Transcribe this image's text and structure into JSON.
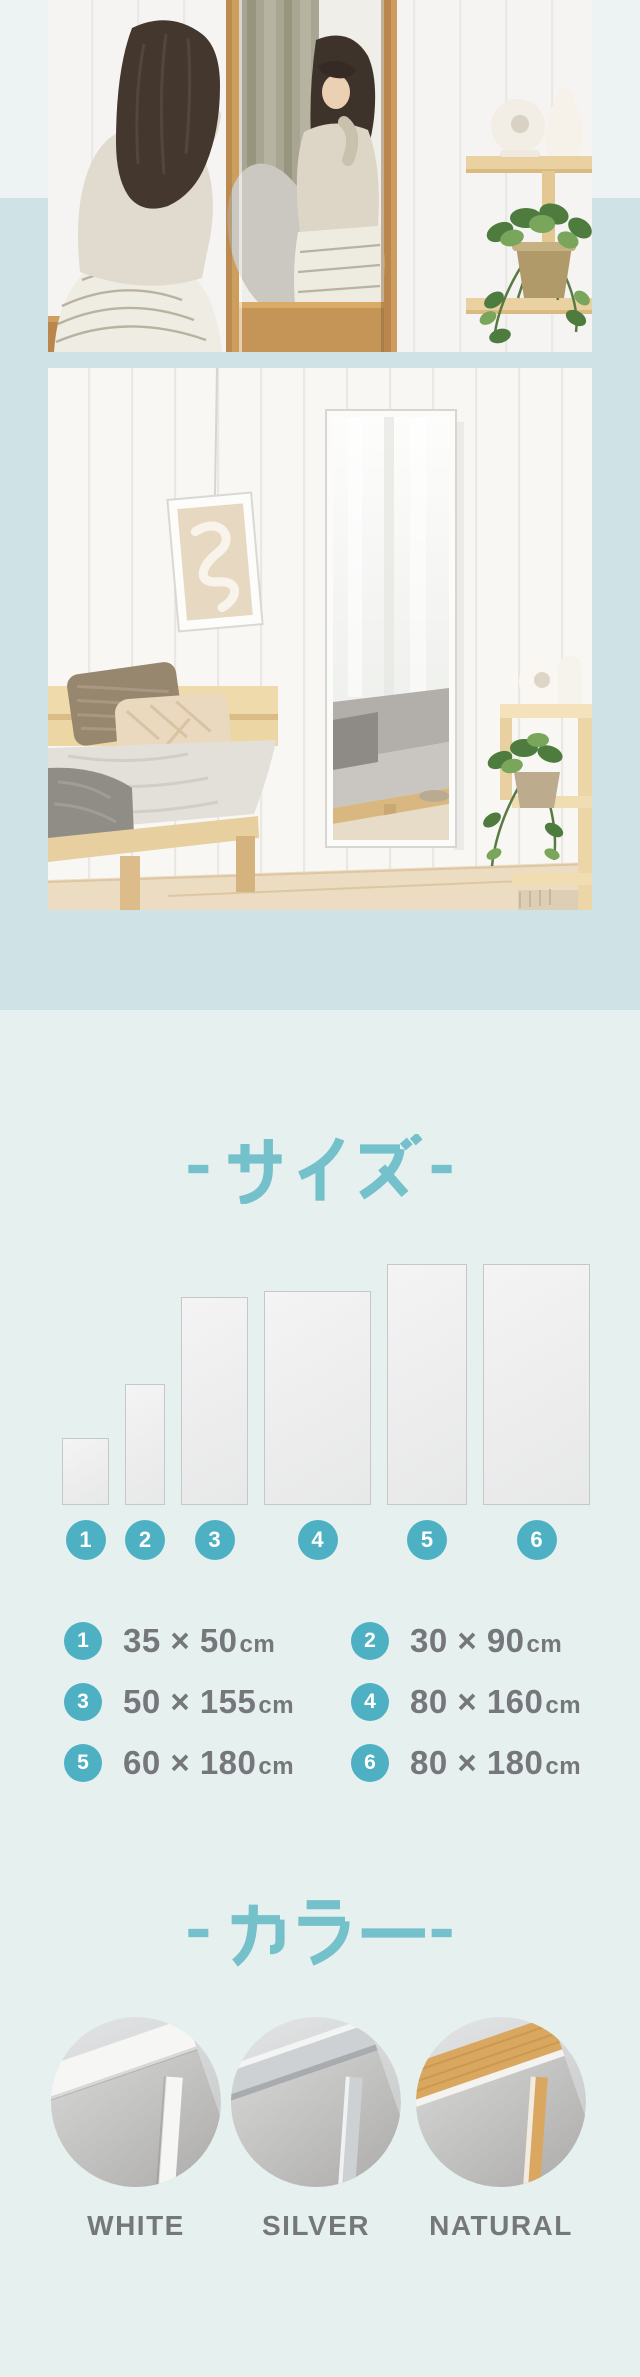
{
  "colors": {
    "accent_teal": "#4db1c3",
    "heading_teal": "#74c0cb",
    "text_grey": "#75777a",
    "band_top": "#edf3f2",
    "band_mid": "#cfe3e7",
    "band_low": "#e5f0ef"
  },
  "photos": {
    "photo1_name": "woman-sitting-in-front-of-wood-frame-full-length-mirror",
    "photo2_name": "white-frame-mirror-on-bedroom-wall"
  },
  "size_section": {
    "heading": "- サイズ -",
    "scale_px_per_cm": 1.34,
    "items": [
      {
        "num": "1",
        "w_cm": 35,
        "h_cm": 50,
        "dims": "35 × 50",
        "unit": "cm"
      },
      {
        "num": "2",
        "w_cm": 30,
        "h_cm": 90,
        "dims": "30 × 90",
        "unit": "cm"
      },
      {
        "num": "3",
        "w_cm": 50,
        "h_cm": 155,
        "dims": "50 × 155",
        "unit": "cm"
      },
      {
        "num": "4",
        "w_cm": 80,
        "h_cm": 160,
        "dims": "80 × 160",
        "unit": "cm"
      },
      {
        "num": "5",
        "w_cm": 60,
        "h_cm": 180,
        "dims": "60 × 180",
        "unit": "cm"
      },
      {
        "num": "6",
        "w_cm": 80,
        "h_cm": 180,
        "dims": "80 × 180",
        "unit": "cm"
      }
    ]
  },
  "color_section": {
    "heading": "- カラー -",
    "swatches": [
      {
        "label": "WHITE",
        "frame_hex": "#f6f6f5"
      },
      {
        "label": "SILVER",
        "frame_hex": "#cdd1d4"
      },
      {
        "label": "NATURAL",
        "frame_hex": "#d9a75f"
      }
    ]
  }
}
